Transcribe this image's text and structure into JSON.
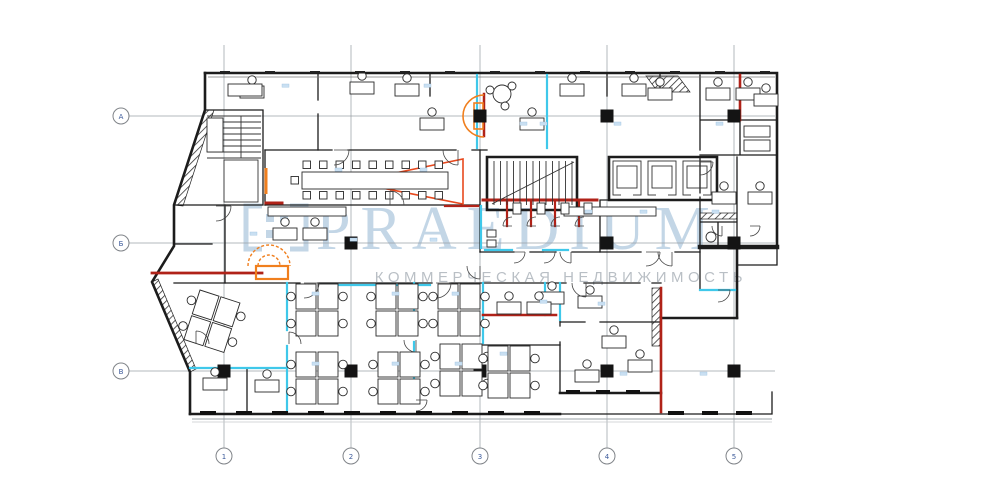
{
  "watermark": {
    "brand": "PRAEDIUM",
    "tagline": "КОММЕРЧЕСКАЯ НЕДВИЖИМОСТЬ",
    "logo": "bracket-dots-logo"
  },
  "grid": {
    "row_labels": [
      "А",
      "Б",
      "В"
    ],
    "col_labels": [
      "1",
      "2",
      "3",
      "4",
      "5"
    ]
  },
  "colors": {
    "wall": "#1c1c1c",
    "grid": "#9aa0a6",
    "cyan": "#3fc8ea",
    "red": "#b02218",
    "orange": "#f07f1e",
    "wmblue": "#b9cfe2",
    "wmgray": "#b6bcc2",
    "triangle": "#e8491e",
    "background": "#ffffff"
  },
  "plan": {
    "type": "office-floor-plan"
  }
}
